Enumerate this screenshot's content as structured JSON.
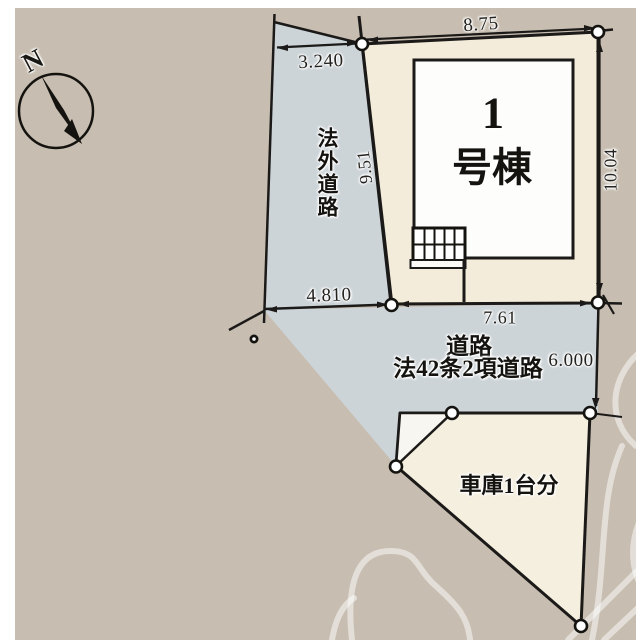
{
  "plan": {
    "compass_label": "N",
    "building": {
      "line1": "1",
      "line2": "号棟"
    },
    "labels": {
      "hogai_road": "法外道路",
      "road_line1": "道路",
      "road_line2": "法42条2項道路",
      "garage": "車庫1台分"
    },
    "dimensions": {
      "strip_top_width": "3.240",
      "lot_top": "8.75",
      "strip_length": "9.51",
      "lot_right": "10.04",
      "bottom_left": "4.810",
      "lot_bottom": "7.61",
      "road_width": "6.000"
    },
    "colors": {
      "background": "#c7bdb0",
      "road": "#cdd4d8",
      "lot": "#f3ecda",
      "garage": "#f5efdf",
      "white_area": "#f7f6f1",
      "line": "#1b1a18"
    }
  }
}
